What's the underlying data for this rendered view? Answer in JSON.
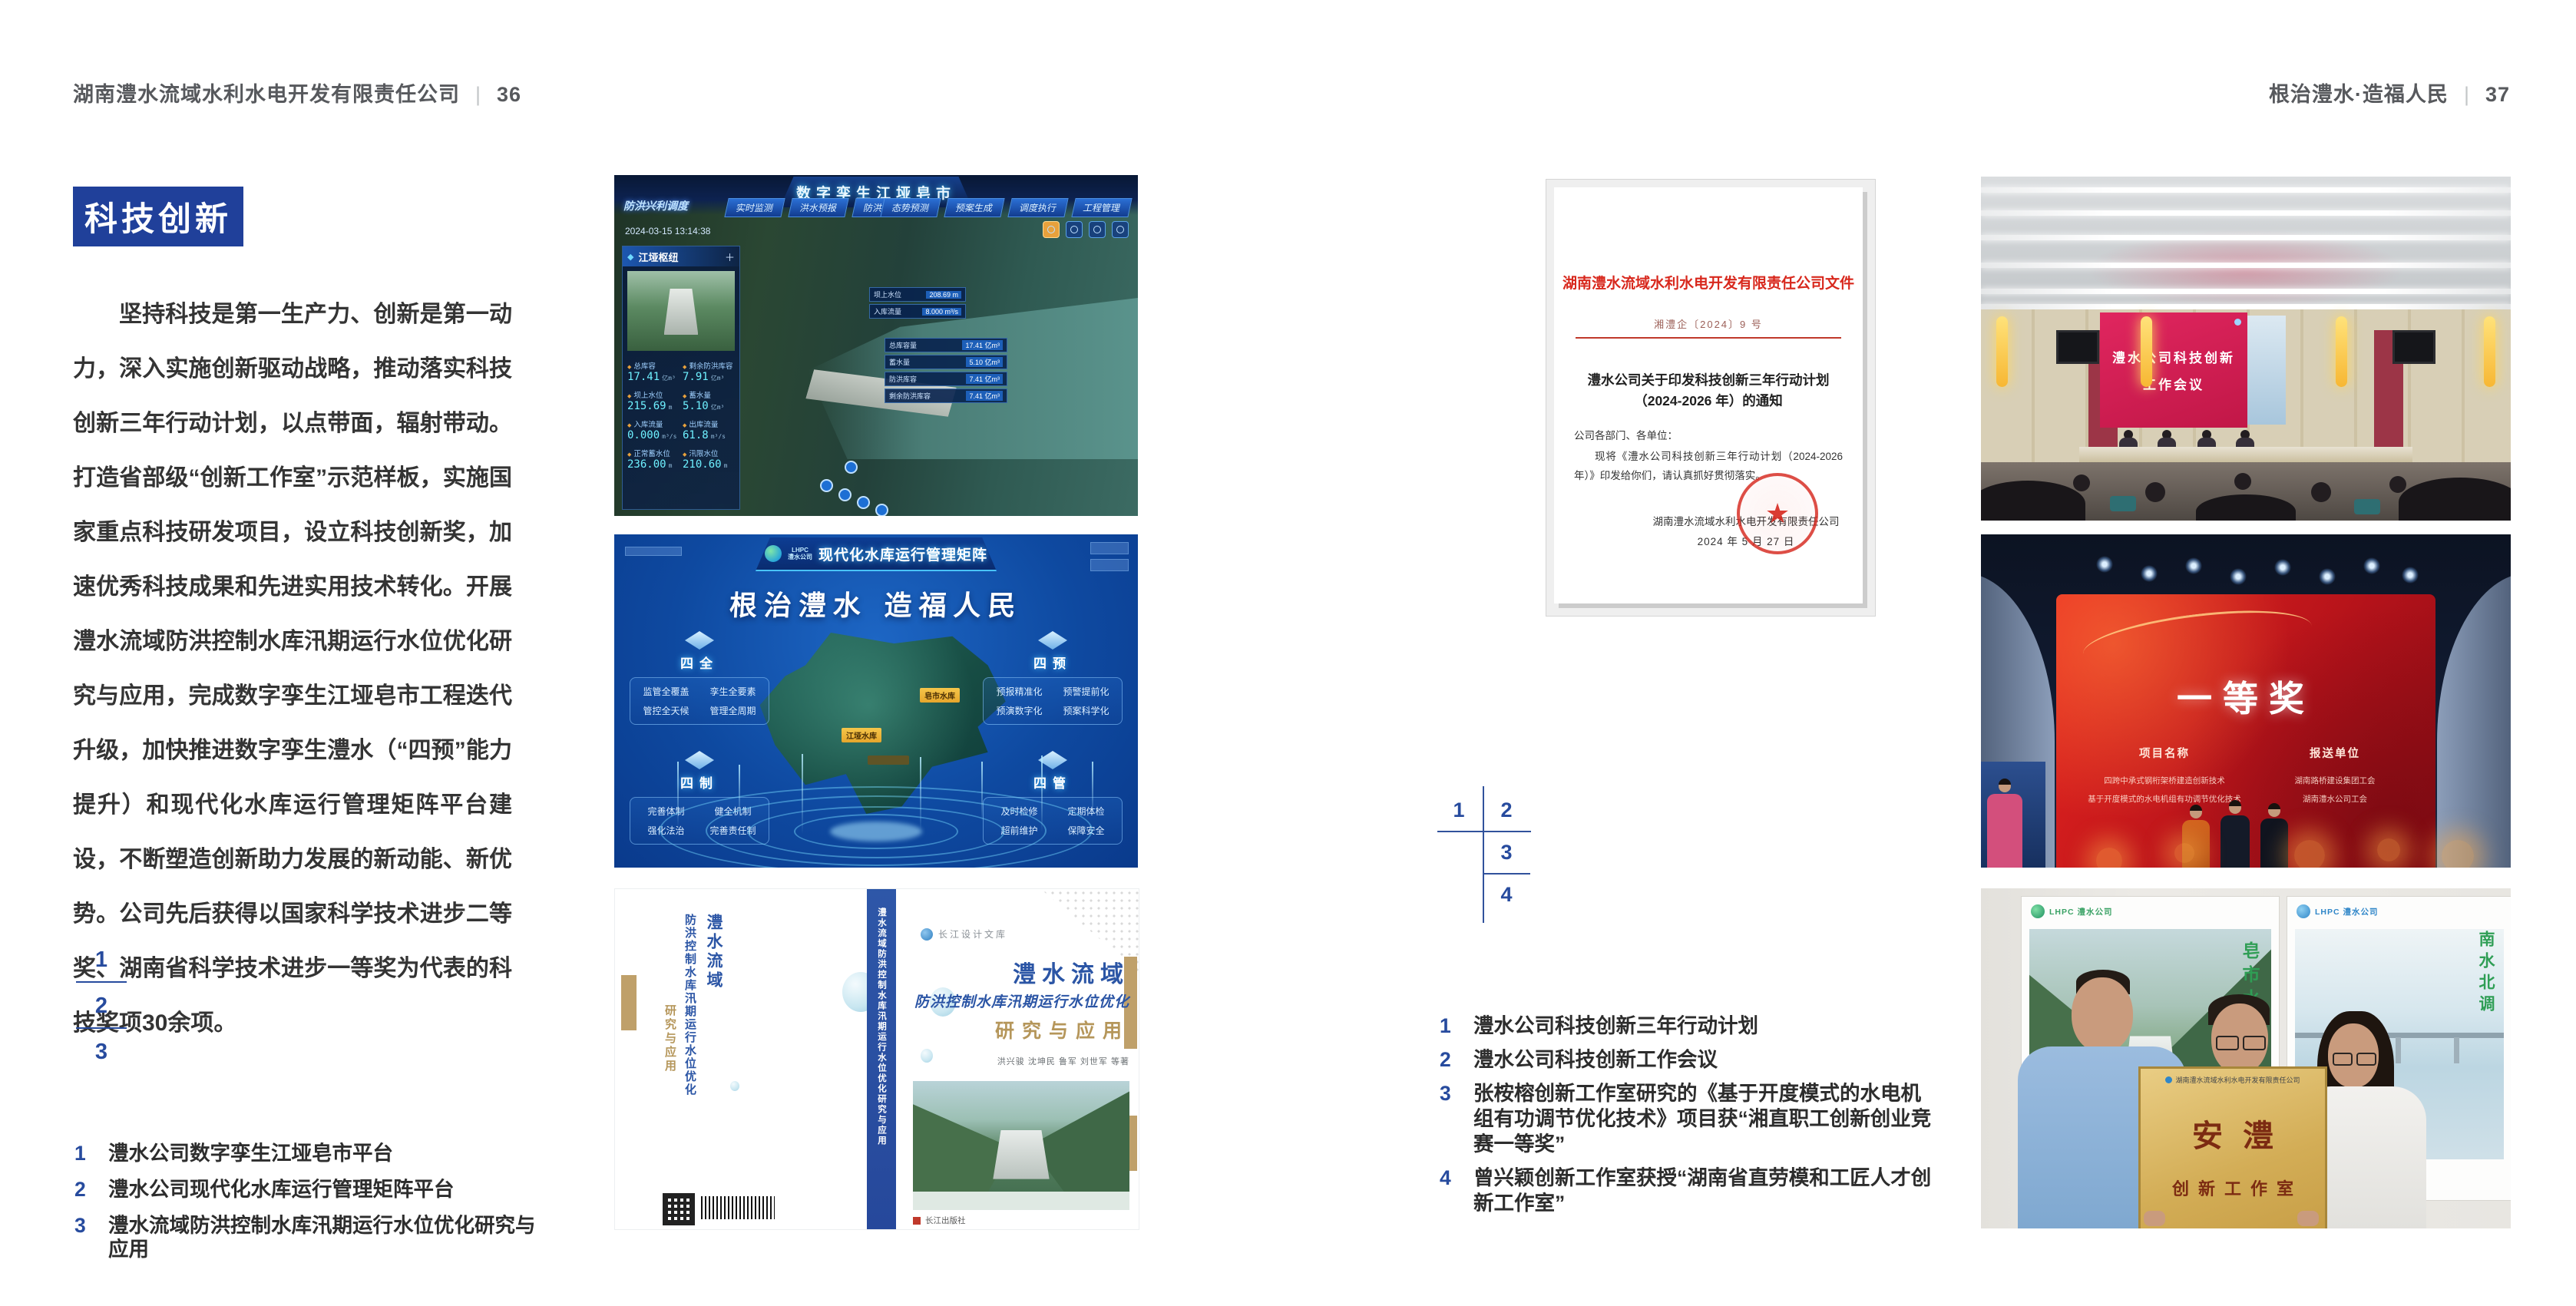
{
  "colors": {
    "accent_blue": "#20409a",
    "index_blue": "#274b9e",
    "doc_red": "#d8281d",
    "screen_red": "#c11747",
    "gold": "#d3ad56"
  },
  "page_left": {
    "header": {
      "title": "湖南澧水流域水利水电开发有限责任公司",
      "divider": "|",
      "page_no": "36"
    },
    "section_title": "科技创新",
    "body": "坚持科技是第一生产力、创新是第一动力，深入实施创新驱动战略，推动落实科技创新三年行动计划，以点带面，辐射带动。打造省部级“创新工作室”示范样板，实施国家重点科技研发项目，设立科技创新奖，加速优秀科技成果和先进实用技术转化。开展澧水流域防洪控制水库汛期运行水位优化研究与应用，完成数字孪生江垭皂市工程迭代升级，加快推进数字孪生澧水（“四预”能力提升）和现代化水库运行管理矩阵平台建设，不断塑造创新助力发展的新动能、新优势。公司先后获得以国家科学技术进步二等奖、湖南省科学技术进步一等奖为代表的科技奖项30余项。",
    "figure_index": {
      "n1": "1",
      "n2": "2",
      "n3": "3"
    },
    "captions": [
      {
        "num": "1",
        "text": "澧水公司数字孪生江垭皂市平台"
      },
      {
        "num": "2",
        "text": "澧水公司现代化水库运行管理矩阵平台"
      },
      {
        "num": "3",
        "text": "澧水流域防洪控制水库汛期运行水位优化研究与应用"
      }
    ]
  },
  "page_right": {
    "header": {
      "title": "根治澧水·造福人民",
      "divider": "|",
      "page_no": "37"
    },
    "figure_index": {
      "n1": "1",
      "n2": "2",
      "n3": "3",
      "n4": "4"
    },
    "captions": [
      {
        "num": "1",
        "text": "澧水公司科技创新三年行动计划"
      },
      {
        "num": "2",
        "text": "澧水公司科技创新工作会议"
      },
      {
        "num": "3",
        "text": "张桉榕创新工作室研究的《基于开度模式的水电机组有功调节优化技术》项目获“湘直职工创新创业竞赛一等奖”"
      },
      {
        "num": "4",
        "text": "曾兴颖创新工作室获授“湖南省直劳模和工匠人才创新工作室”"
      }
    ]
  },
  "dashboard": {
    "title": "数字孪生江垭皂市",
    "mode_label": "防洪兴利调度",
    "timestamp": "2024-03-15 13:14:38",
    "tabs_left": [
      {
        "label": "实时监测"
      },
      {
        "label": "洪水预报"
      },
      {
        "label": "防洪预演"
      }
    ],
    "tabs_right": [
      {
        "label": "态势预测"
      },
      {
        "label": "预案生成"
      },
      {
        "label": "调度执行"
      },
      {
        "label": "工程管理"
      }
    ],
    "panel_title": "江垭枢纽",
    "stats": [
      {
        "label": "总库容",
        "value": "17.41",
        "unit": "亿m³"
      },
      {
        "label": "剩余防洪库容",
        "value": "7.91",
        "unit": "亿m³"
      },
      {
        "label": "坝上水位",
        "value": "215.69",
        "unit": "m"
      },
      {
        "label": "蓄水量",
        "value": "5.10",
        "unit": "亿m³"
      },
      {
        "label": "入库流量",
        "value": "0.000",
        "unit": "m³/s"
      },
      {
        "label": "出库流量",
        "value": "61.8",
        "unit": "m³/s"
      },
      {
        "label": "正常蓄水位",
        "value": "236.00",
        "unit": "m"
      },
      {
        "label": "汛限水位",
        "value": "210.60",
        "unit": "m"
      }
    ],
    "popup1": [
      {
        "label": "坝上水位",
        "value": "208.69 m"
      },
      {
        "label": "入库流量",
        "value": "8.000 m³/s"
      }
    ],
    "popup2": [
      {
        "label": "总库容量",
        "value": "17.41 亿m³"
      },
      {
        "label": "蓄水量",
        "value": "5.10 亿m³"
      },
      {
        "label": "防洪库容",
        "value": "7.41 亿m³"
      },
      {
        "label": "剩余防洪库容",
        "value": "7.41 亿m³"
      }
    ]
  },
  "matrix": {
    "logo_line1": "LHPC",
    "logo_line2": "澧水公司",
    "title": "现代化水库运行管理矩阵",
    "slogan": "根治澧水 造福人民",
    "quadrants": [
      {
        "name": "四全",
        "items": [
          "监管全覆盖",
          "孪生全要素",
          "管控全天候",
          "管理全周期"
        ]
      },
      {
        "name": "四预",
        "items": [
          "预报精准化",
          "预警提前化",
          "预演数字化",
          "预案科学化"
        ]
      },
      {
        "name": "四制",
        "items": [
          "完善体制",
          "健全机制",
          "强化法治",
          "完善责任制"
        ]
      },
      {
        "name": "四管",
        "items": [
          "及时检修",
          "定期体检",
          "超前维护",
          "保障安全"
        ]
      }
    ],
    "map_labels": [
      "皂市水库",
      "江垭水库"
    ]
  },
  "book": {
    "series_logo": "长江设计文库",
    "title_line1": "澧水流域",
    "title_line2": "防洪控制水库汛期运行水位优化",
    "title_line3": "研究与应用",
    "authors": "洪兴骏 沈坤民 鲁军 刘世军 等著",
    "spine_text": "澧水流域防洪控制水库汛期运行水位优化研究与应用",
    "publisher": "长江出版社"
  },
  "document": {
    "masthead": "湖南澧水流域水利水电开发有限责任公司文件",
    "doc_no": "湘澧企〔2024〕9 号",
    "title_line1": "澧水公司关于印发科技创新三年行动计划",
    "title_line2": "（2024-2026 年）的通知",
    "salutation": "公司各部门、各单位：",
    "body": "现将《澧水公司科技创新三年行动计划（2024-2026 年）》印发给你们，请认真抓好贯彻落实。",
    "signer": "湖南澧水流域水利水电开发有限责任公司",
    "date": "2024 年 5 月 27 日",
    "seal_star": "★"
  },
  "meeting": {
    "screen_line1": "澧水公司科技创新",
    "screen_line2": "工作会议"
  },
  "award": {
    "award_title": "一等奖",
    "col1_header": "项目名称",
    "col1_rows": [
      "四跨中承式钢桁架桥建造创新技术",
      "基于开度模式的水电机组有功调节优化技术"
    ],
    "col2_header": "报送单位",
    "col2_rows": [
      "湖南路桥建设集团工会",
      "湖南澧水公司工会"
    ]
  },
  "group": {
    "poster_logo": "LHPC 澧水公司",
    "poster1_caption": "皂市水库",
    "poster2_caption": "南水北调",
    "plaque_header": "湖南澧水流域水利水电开发有限责任公司",
    "plaque_title": "安澧",
    "plaque_subtitle": "创新工作室"
  }
}
